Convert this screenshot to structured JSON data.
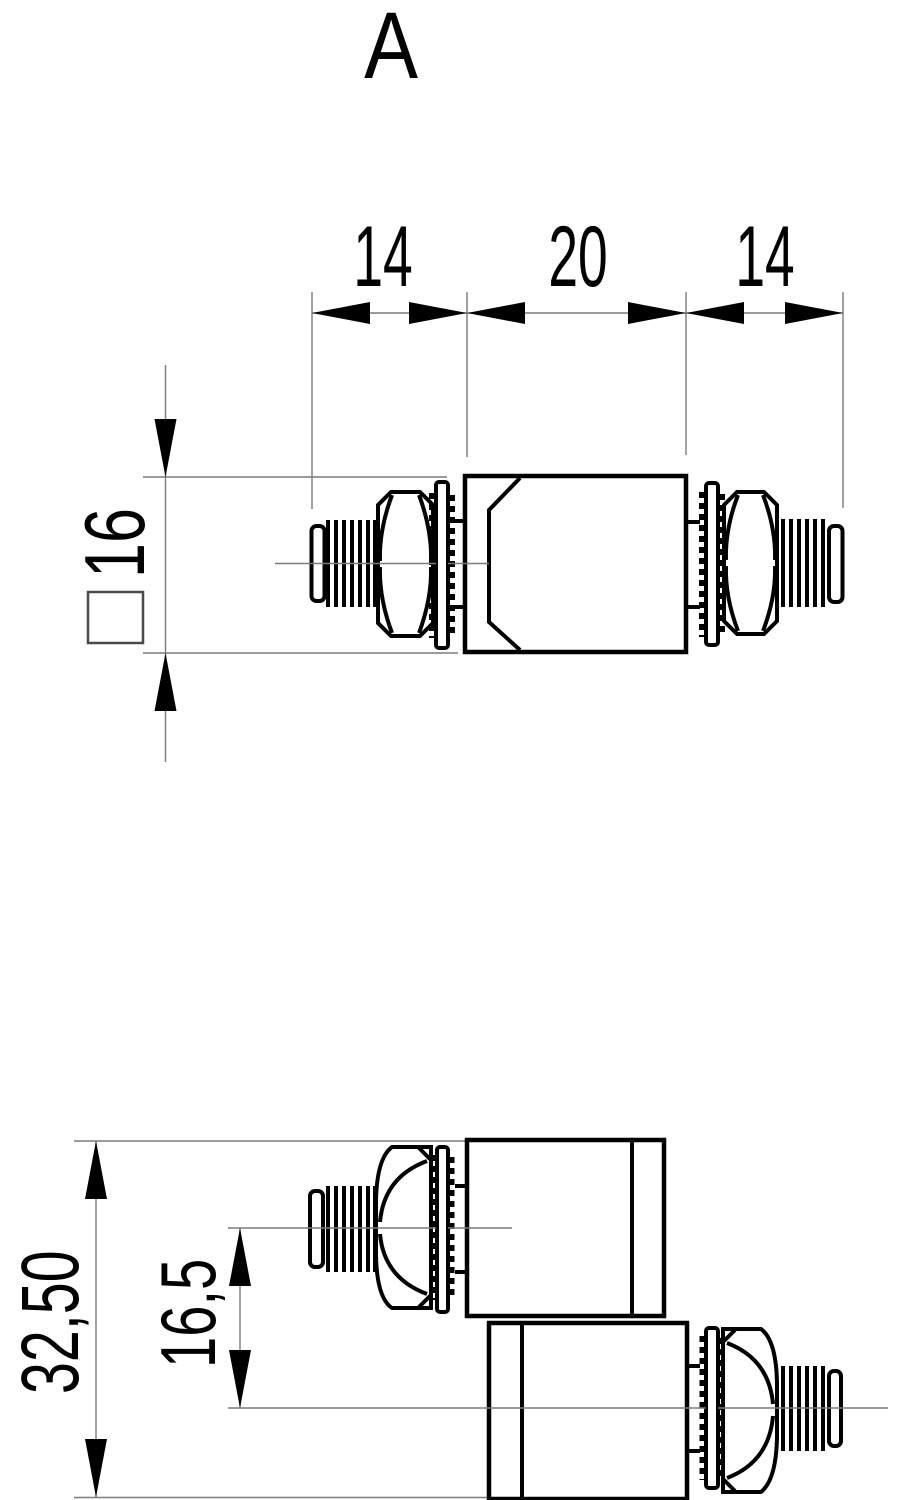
{
  "drawing": {
    "view_label": "A",
    "top_view": {
      "dim_thread_left": "14",
      "dim_body_length": "20",
      "dim_thread_right": "14",
      "dim_square_height": "16",
      "square_symbol": "square-section-indicator"
    },
    "bottom_view": {
      "dim_overall_height": "32,50",
      "dim_axis_offset": "16,5"
    },
    "colors": {
      "outline": "#000000",
      "thin_line": "#7b7b7b",
      "background": "#ffffff"
    }
  }
}
